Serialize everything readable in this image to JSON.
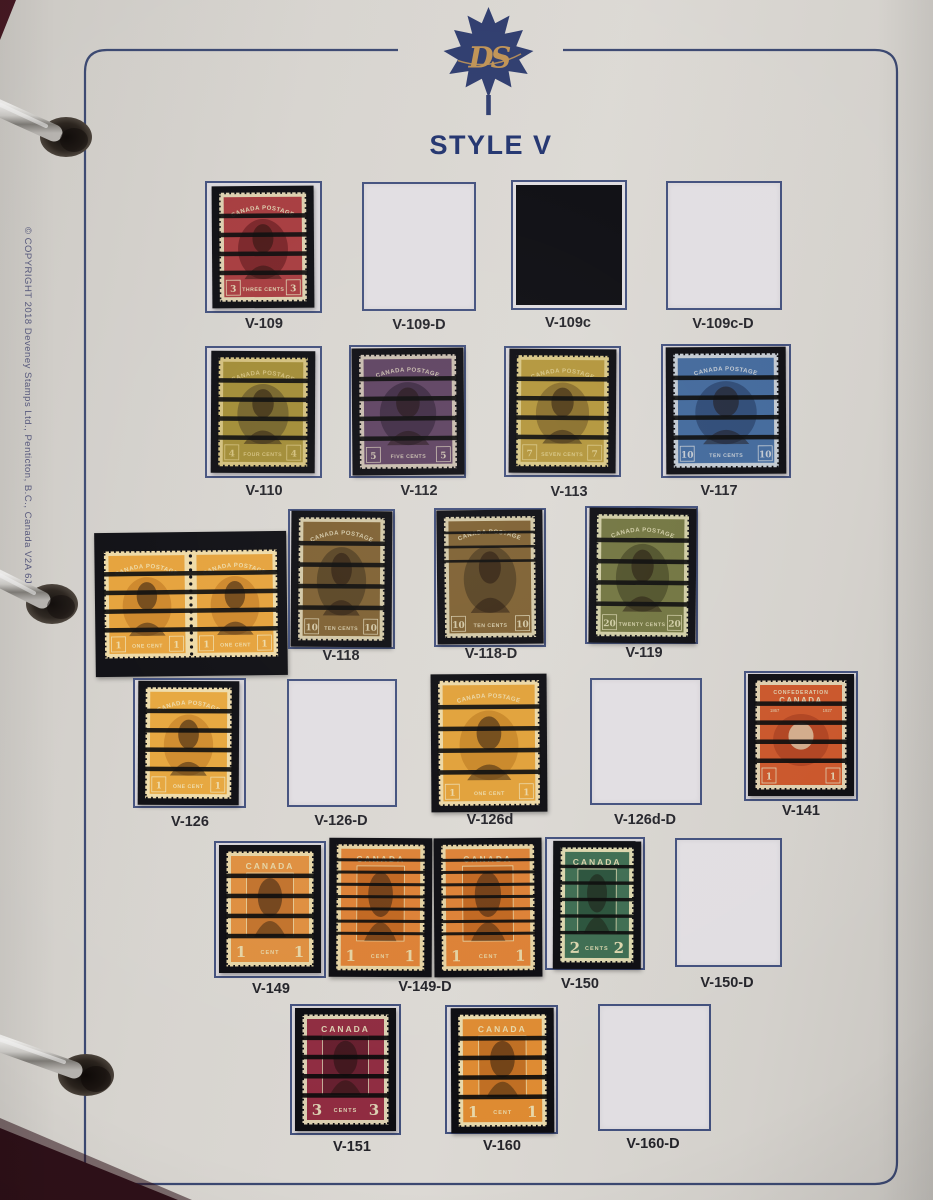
{
  "page": {
    "title": "STYLE V",
    "logo_monogram": "DS",
    "copyright_text": "© COPYRIGHT  2018  Deveney Stamps Ltd., Penticton, B.C., Canada V2A 6J9"
  },
  "colors": {
    "page_background": "#d7d4cf",
    "page_border": "#33406b",
    "title_text": "#21336e",
    "caption_text": "#232329",
    "copyright_text": "#55577c",
    "printed_box_fill": "#e1dee2",
    "printed_box_border": "#42507d",
    "mount_black": "#0c0c11",
    "precancel_bar": "#0a0a0a",
    "logo_leaf": "#2e3c6e",
    "logo_gold": "#c09355",
    "ring_metal": "#cfcdc9"
  },
  "captions": [
    {
      "text": "V-109",
      "x": 264,
      "y": 316
    },
    {
      "text": "V-109-D",
      "x": 419,
      "y": 317
    },
    {
      "text": "V-109c",
      "x": 568,
      "y": 315
    },
    {
      "text": "V-109c-D",
      "x": 723,
      "y": 316
    },
    {
      "text": "V-110",
      "x": 264,
      "y": 483
    },
    {
      "text": "V-112",
      "x": 419,
      "y": 483
    },
    {
      "text": "V-113",
      "x": 569,
      "y": 484
    },
    {
      "text": "V-117",
      "x": 719,
      "y": 483
    },
    {
      "text": "V-118",
      "x": 341,
      "y": 648
    },
    {
      "text": "V-118-D",
      "x": 491,
      "y": 646
    },
    {
      "text": "V-119",
      "x": 644,
      "y": 645
    },
    {
      "text": "V-126",
      "x": 190,
      "y": 814
    },
    {
      "text": "V-126-D",
      "x": 341,
      "y": 813
    },
    {
      "text": "V-126d",
      "x": 490,
      "y": 812
    },
    {
      "text": "V-126d-D",
      "x": 645,
      "y": 812
    },
    {
      "text": "V-141",
      "x": 801,
      "y": 803
    },
    {
      "text": "V-149",
      "x": 271,
      "y": 981
    },
    {
      "text": "V-149-D",
      "x": 425,
      "y": 979
    },
    {
      "text": "V-150",
      "x": 580,
      "y": 976
    },
    {
      "text": "V-150-D",
      "x": 727,
      "y": 975
    },
    {
      "text": "V-151",
      "x": 352,
      "y": 1139
    },
    {
      "text": "V-160",
      "x": 502,
      "y": 1138
    },
    {
      "text": "V-160-D",
      "x": 653,
      "y": 1136
    }
  ],
  "cells": [
    {
      "name": "V-109",
      "kind": "stamp",
      "box": [
        205,
        181,
        117,
        132
      ],
      "mount": [
        212,
        186,
        102,
        122
      ],
      "tilt": -0.4,
      "stamp": {
        "style": "admiral",
        "ink": "#a63a3d",
        "dark": "#7a2327",
        "paper": "#dccfae",
        "top": "CANADA POSTAGE",
        "num": "3",
        "value": "THREE CENTS",
        "bars": 4
      }
    },
    {
      "name": "V-109-D",
      "kind": "empty",
      "box": [
        362,
        182,
        114,
        129
      ]
    },
    {
      "name": "V-109c",
      "kind": "filled",
      "box": [
        511,
        180,
        116,
        130
      ]
    },
    {
      "name": "V-109c-D",
      "kind": "empty",
      "box": [
        666,
        181,
        116,
        129
      ]
    },
    {
      "name": "V-110",
      "kind": "stamp",
      "box": [
        205,
        346,
        117,
        132
      ],
      "mount": [
        211,
        351,
        104,
        122
      ],
      "tilt": 0.3,
      "stamp": {
        "style": "admiral",
        "ink": "#a18b34",
        "dark": "#756429",
        "paper": "#d2bf7d",
        "top": "CANADA POSTAGE",
        "num": "4",
        "value": "FOUR CENTS",
        "bars": 4
      }
    },
    {
      "name": "V-112",
      "kind": "stamp",
      "box": [
        349,
        345,
        117,
        133
      ],
      "mount": [
        352,
        348,
        112,
        127
      ],
      "tilt": -0.5,
      "stamp": {
        "style": "admiral",
        "ink": "#5d4160",
        "dark": "#3f2b44",
        "paper": "#c8bcae",
        "top": "CANADA POSTAGE",
        "num": "5",
        "value": "FIVE CENTS",
        "bars": 4
      }
    },
    {
      "name": "V-113",
      "kind": "stamp",
      "box": [
        504,
        346,
        117,
        131
      ],
      "mount": [
        509,
        349,
        107,
        124
      ],
      "tilt": 0.4,
      "stamp": {
        "style": "admiral",
        "ink": "#b3953a",
        "dark": "#8a6f2b",
        "paper": "#d7c685",
        "top": "CANADA POSTAGE",
        "num": "7",
        "value": "SEVEN CENTS",
        "bars": 4
      }
    },
    {
      "name": "V-117",
      "kind": "stamp",
      "box": [
        661,
        344,
        130,
        134
      ],
      "mount": [
        666,
        347,
        120,
        127
      ],
      "tilt": -0.3,
      "stamp": {
        "style": "admiral",
        "ink": "#41689b",
        "dark": "#2d4a76",
        "paper": "#c2c9d1",
        "top": "CANADA POSTAGE",
        "num": "10",
        "value": "TEN CENTS",
        "bars": 4
      }
    },
    {
      "name": "coil-pair",
      "kind": "pair",
      "mount": [
        95,
        532,
        192,
        144
      ],
      "tilt": -0.7,
      "stamp": {
        "style": "admiral",
        "ink": "#e5a139",
        "dark": "#cd8628",
        "paper": "#eedaa6",
        "top": "CANADA POSTAGE",
        "num": "1",
        "value": "ONE CENT",
        "bars": 4
      }
    },
    {
      "name": "V-118",
      "kind": "stamp",
      "box": [
        288,
        509,
        107,
        140
      ],
      "mount": [
        291,
        511,
        101,
        136
      ],
      "tilt": 0.4,
      "stamp": {
        "style": "admiral",
        "ink": "#7d5f30",
        "dark": "#584322",
        "paper": "#d2c7a6",
        "top": "CANADA POSTAGE",
        "num": "10",
        "value": "TEN CENTS",
        "bars": 4
      }
    },
    {
      "name": "V-118-D",
      "kind": "stamp",
      "box": [
        434,
        508,
        112,
        139
      ],
      "mount": [
        437,
        510,
        106,
        134
      ],
      "tilt": -0.6,
      "stamp": {
        "style": "admiral",
        "ink": "#7d5f30",
        "dark": "#584322",
        "paper": "#d2c7a6",
        "top": "CANADA POSTAGE",
        "num": "10",
        "value": "TEN CENTS",
        "bars": 3
      }
    },
    {
      "name": "V-119",
      "kind": "stamp",
      "box": [
        585,
        506,
        113,
        138
      ],
      "mount": [
        589,
        508,
        107,
        135
      ],
      "tilt": 0.5,
      "stamp": {
        "style": "admiral",
        "ink": "#71743f",
        "dark": "#50522a",
        "paper": "#cfcca4",
        "top": "CANADA POSTAGE",
        "num": "20",
        "value": "TWENTY CENTS",
        "bars": 4
      }
    },
    {
      "name": "V-126",
      "kind": "stamp",
      "box": [
        133,
        678,
        113,
        130
      ],
      "mount": [
        138,
        681,
        101,
        124
      ],
      "tilt": 0.3,
      "stamp": {
        "style": "admiral",
        "ink": "#e6a63c",
        "dark": "#cf8b2b",
        "paper": "#eedbaa",
        "top": "CANADA POSTAGE",
        "num": "1",
        "value": "ONE CENT",
        "bars": 4
      }
    },
    {
      "name": "V-126-D",
      "kind": "empty",
      "box": [
        287,
        679,
        110,
        128
      ]
    },
    {
      "name": "V-126d",
      "kind": "stamp",
      "box": [
        439,
        678,
        104,
        129
      ],
      "mount": [
        431,
        674,
        116,
        138
      ],
      "tilt": -0.4,
      "stamp": {
        "style": "admiral",
        "ink": "#e1a037",
        "dark": "#c98726",
        "paper": "#ebd7a5",
        "top": "CANADA POSTAGE",
        "num": "1",
        "value": "ONE CENT",
        "bars": 4
      }
    },
    {
      "name": "V-126d-D",
      "kind": "empty",
      "box": [
        590,
        678,
        112,
        127
      ]
    },
    {
      "name": "V-141",
      "kind": "stamp",
      "box": [
        744,
        671,
        114,
        130
      ],
      "mount": [
        748,
        674,
        106,
        122
      ],
      "tilt": 0,
      "stamp": {
        "style": "confed",
        "ink": "#ca5529",
        "dark": "#b04320",
        "paper": "#ddceae",
        "top": "CONFEDERATION",
        "top2": "CANADA",
        "num": "1",
        "value": "",
        "bars": 4
      }
    },
    {
      "name": "V-149",
      "kind": "stamp",
      "box": [
        214,
        841,
        112,
        137
      ],
      "mount": [
        219,
        845,
        102,
        128
      ],
      "tilt": 0,
      "stamp": {
        "style": "scroll",
        "ink": "#de8e3e",
        "dark": "#c2722b",
        "paper": "#e5d4a5",
        "top": "CANADA",
        "num": "1",
        "value": "CENT",
        "bars": 4
      }
    },
    {
      "name": "V-149-D-left",
      "kind": "stamp",
      "mount": [
        329,
        838,
        103,
        139
      ],
      "tilt": 0.3,
      "stamp": {
        "style": "scroll",
        "ink": "#dc8034",
        "dark": "#c1661f",
        "paper": "#e3d1a1",
        "top": "CANADA",
        "num": "1",
        "value": "CENT",
        "bars": 7
      }
    },
    {
      "name": "V-149-D-right",
      "kind": "stamp",
      "mount": [
        434,
        838,
        108,
        139
      ],
      "tilt": -0.4,
      "stamp": {
        "style": "scroll",
        "ink": "#dc8034",
        "dark": "#c1661f",
        "paper": "#e3d1a1",
        "top": "CANADA",
        "num": "1",
        "value": "CENT",
        "bars": 7
      }
    },
    {
      "name": "V-150",
      "kind": "stamp",
      "box": [
        545,
        837,
        100,
        133
      ],
      "mount": [
        553,
        841,
        88,
        128
      ],
      "tilt": 0.2,
      "stamp": {
        "style": "scroll",
        "ink": "#3d6c51",
        "dark": "#2a523b",
        "paper": "#dbd5ad",
        "top": "CANADA",
        "num": "2",
        "value": "CENTS",
        "bars": 5
      }
    },
    {
      "name": "V-150-D",
      "kind": "empty",
      "box": [
        675,
        838,
        107,
        129
      ]
    },
    {
      "name": "V-151",
      "kind": "stamp",
      "box": [
        290,
        1004,
        111,
        131
      ],
      "mount": [
        295,
        1008,
        101,
        123
      ],
      "tilt": 0,
      "stamp": {
        "style": "scroll",
        "ink": "#8f2b40",
        "dark": "#661e2e",
        "paper": "#dbcfb1",
        "top": "CANADA",
        "num": "3",
        "value": "CENTS",
        "bars": 4
      }
    },
    {
      "name": "V-160",
      "kind": "stamp",
      "box": [
        445,
        1005,
        113,
        129
      ],
      "mount": [
        451,
        1008,
        103,
        125
      ],
      "tilt": -0.3,
      "stamp": {
        "style": "scroll",
        "ink": "#de8a31",
        "dark": "#bf6e22",
        "paper": "#e7d8aa",
        "top": "CANADA",
        "num": "1",
        "value": "CENT",
        "bars": 4
      }
    },
    {
      "name": "V-160-D",
      "kind": "empty",
      "box": [
        598,
        1004,
        113,
        127
      ]
    }
  ]
}
